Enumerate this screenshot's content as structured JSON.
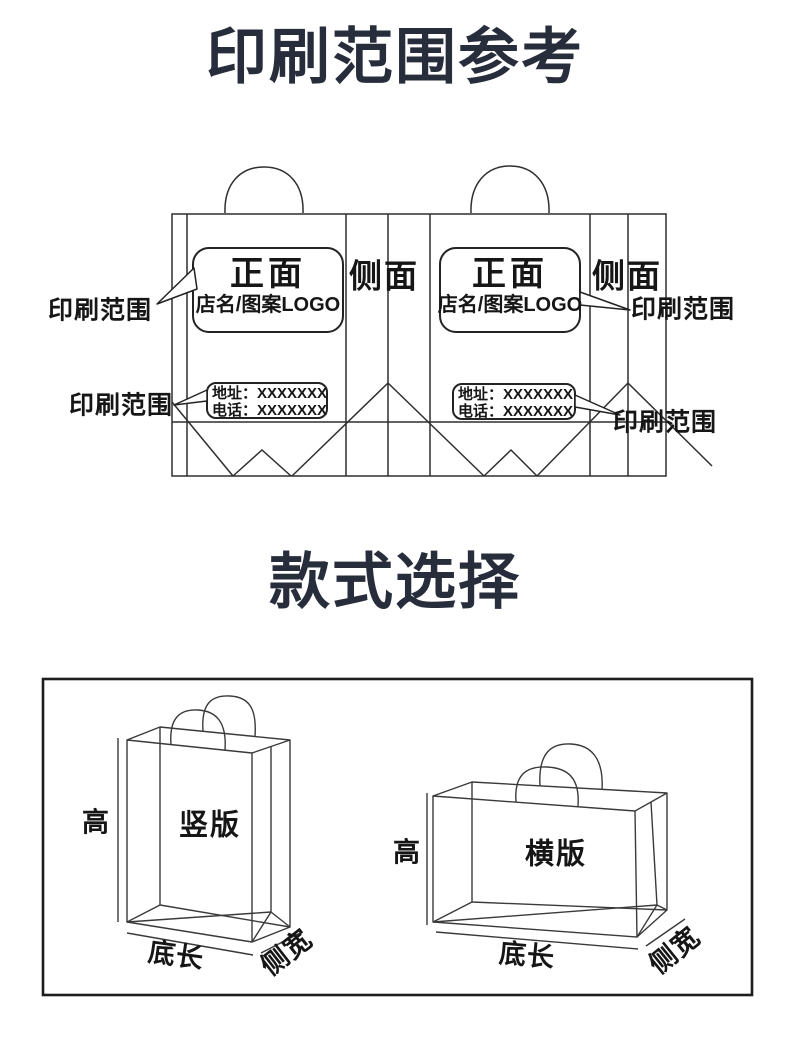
{
  "colors": {
    "ink": "#2f2f2f",
    "title": "#272d3b",
    "background": "#ffffff"
  },
  "print_reference": {
    "title": "印刷范围参考",
    "panels": {
      "front_label": "正面",
      "front_sublabel": "店名/图案LOGO",
      "side_label": "侧面"
    },
    "address_box": {
      "line1": "地址：XXXXXXX",
      "line2": "电话：XXXXXXX"
    },
    "print_range_label": "印刷范围"
  },
  "style_selection": {
    "title": "款式选择",
    "vertical_bag_label": "竖版",
    "horizontal_bag_label": "横版",
    "height_label": "高",
    "bottom_length_label": "底长",
    "side_width_label": "侧宽"
  }
}
